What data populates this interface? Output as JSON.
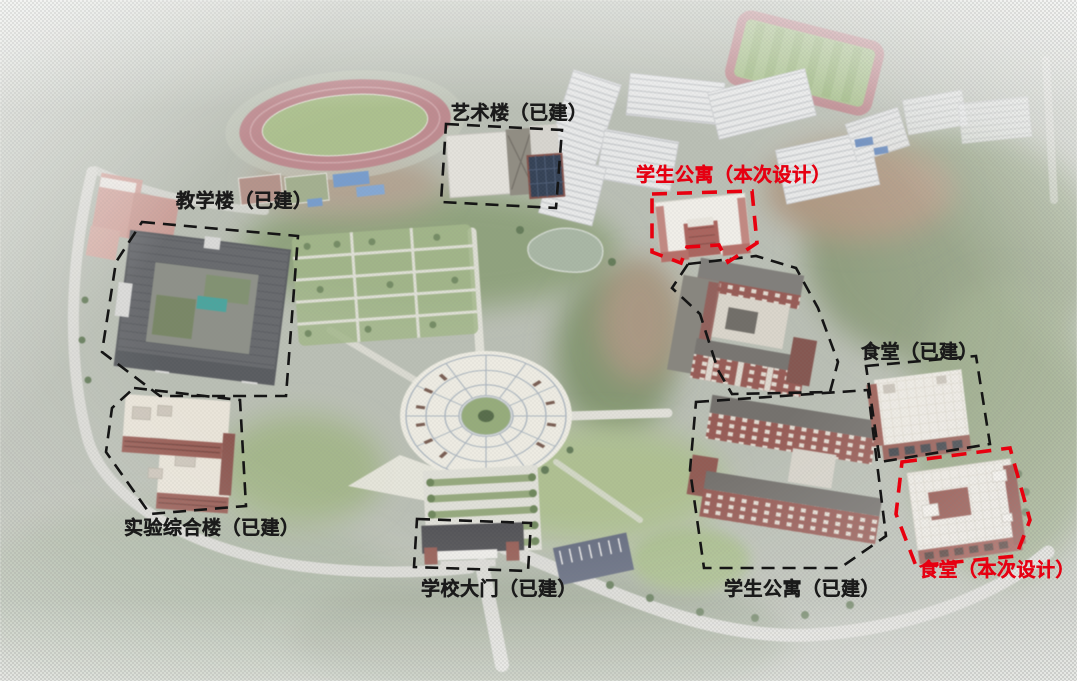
{
  "legend": {
    "built_outline_color": "#151515",
    "design_outline_color": "#e8000f",
    "built_outline_style": "dashed",
    "design_outline_style": "dashed",
    "label_black": "#1b1b1b",
    "label_red": "#e60012"
  },
  "labels": [
    {
      "id": "teaching-building",
      "text": "教学楼（已建）",
      "name": "教学楼",
      "status": "已建",
      "style": "black"
    },
    {
      "id": "art-building",
      "text": "艺术楼（已建）",
      "name": "艺术楼",
      "status": "已建",
      "style": "black"
    },
    {
      "id": "dorm-new",
      "text": "学生公寓（本次设计）",
      "name": "学生公寓",
      "status": "本次设计",
      "style": "red"
    },
    {
      "id": "lab-building",
      "text": "实验综合楼（已建）",
      "name": "实验综合楼",
      "status": "已建",
      "style": "black"
    },
    {
      "id": "school-gate",
      "text": "学校大门（已建）",
      "name": "学校大门",
      "status": "已建",
      "style": "black"
    },
    {
      "id": "dorm-built",
      "text": "学生公寓（已建）",
      "name": "学生公寓",
      "status": "已建",
      "style": "black"
    },
    {
      "id": "canteen-built",
      "text": "食堂（已建）",
      "name": "食堂",
      "status": "已建",
      "style": "black"
    },
    {
      "id": "canteen-new",
      "text": "食堂（本次设计）",
      "name": "食堂",
      "status": "本次设计",
      "style": "red"
    }
  ]
}
